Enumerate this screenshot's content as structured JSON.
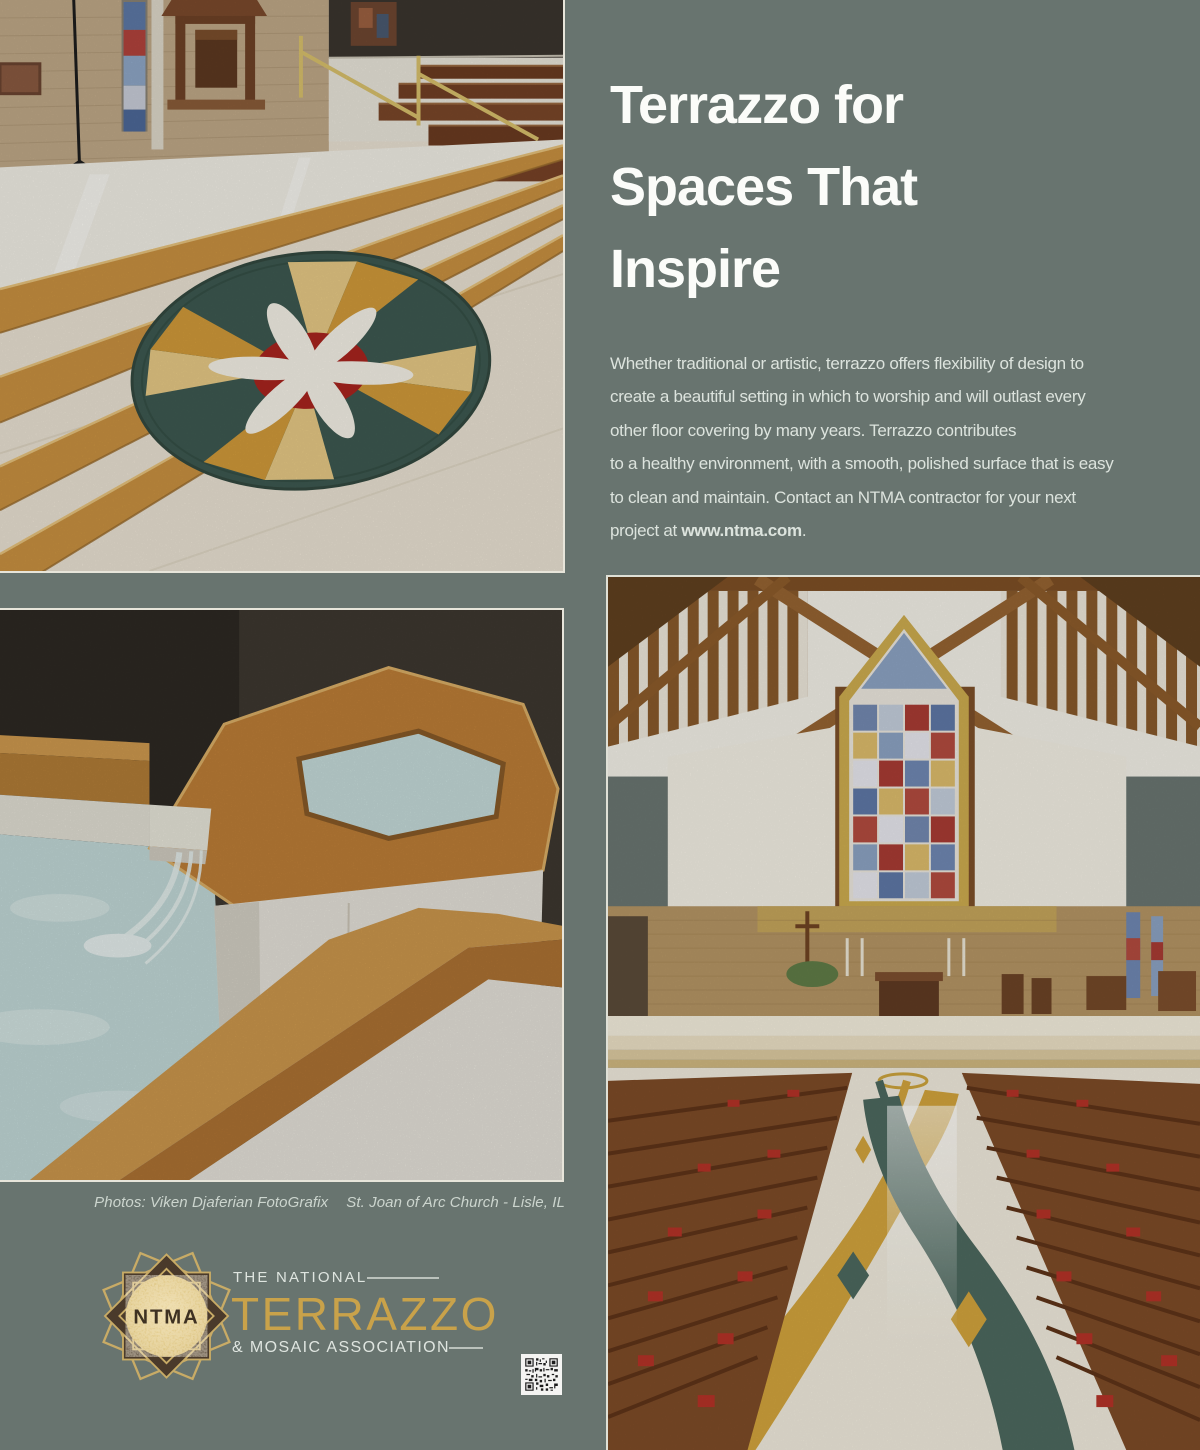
{
  "colors": {
    "background": "#68746f",
    "headline_text": "#fbfcf9",
    "body_text": "#dce3dd",
    "caption_text": "#ccd5ce",
    "logo_gold": "#c9a24a",
    "logo_light": "#dfe5e0",
    "logo_dark_brown": "#4a3a2b",
    "terrazzo_amber": "#c9913f",
    "terrazzo_teal": "#4c675d",
    "terrazzo_cream": "#eae3d4",
    "medallion_green": "#3d5950",
    "medallion_red": "#a8241e"
  },
  "headline": {
    "lines": [
      "Terrazzo for",
      "Spaces That",
      "Inspire"
    ]
  },
  "body": {
    "lines": [
      "Whether traditional or artistic, terrazzo offers flexibility of design to",
      "create a beautiful setting in which to worship and will outlast every",
      "other floor covering by many years. Terrazzo contributes",
      "to a healthy environment, with a smooth, polished surface that is easy",
      "to clean and maintain. Contact an NTMA contractor for your next"
    ],
    "closing_prefix": "project at ",
    "website": "www.ntma.com",
    "closing_suffix": "."
  },
  "caption": {
    "credit": "Photos: Viken Djaferian FotoGrafix",
    "location": "St. Joan of Arc Church - Lisle, IL"
  },
  "logo": {
    "monogram": "NTMA",
    "tagline_top": "THE NATIONAL",
    "name": "TERRAZZO",
    "tagline_bottom": "& MOSAIC ASSOCIATION"
  }
}
